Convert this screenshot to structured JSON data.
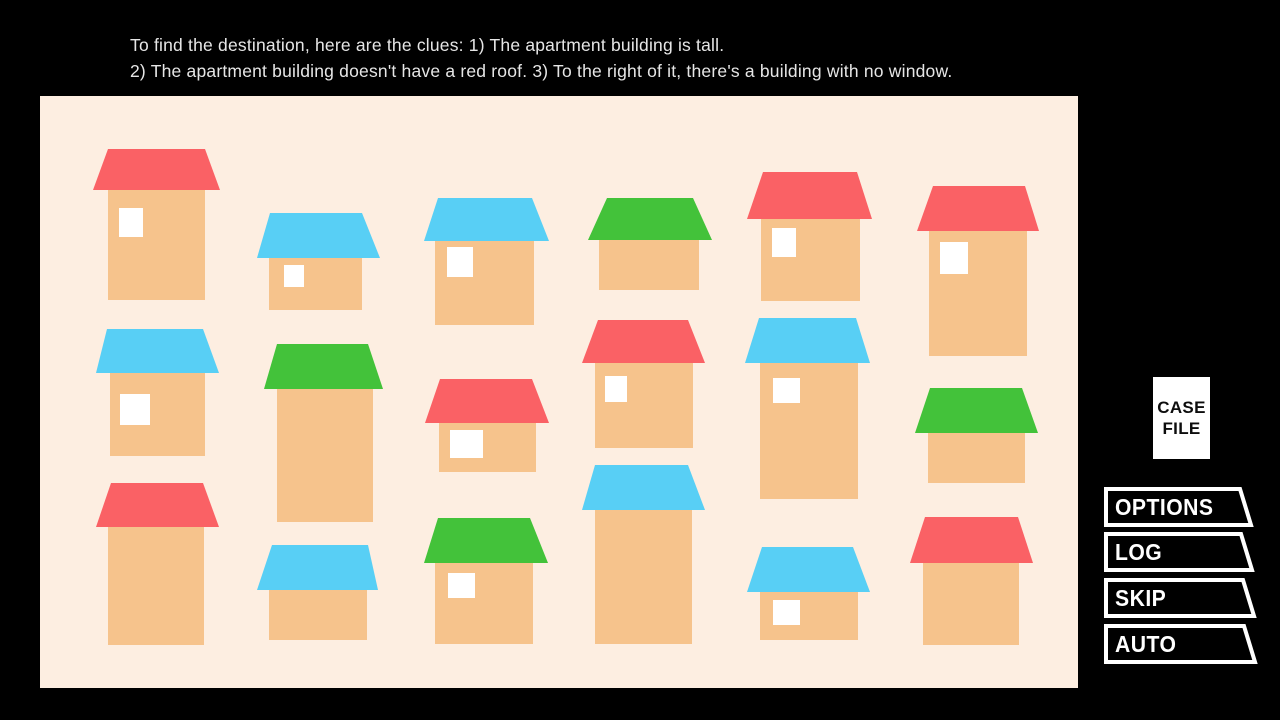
{
  "clue": {
    "line1": "To find the destination, here are the clues: 1) The apartment building is tall.",
    "line2": "2) The apartment building doesn't have a red roof. 3) To the right of it, there's a building with no window."
  },
  "palette": {
    "background": "#000000",
    "panel": "#fdeee1",
    "building_body": "#f6c38c",
    "roof_red": "#fa6165",
    "roof_blue": "#58cff5",
    "roof_green": "#43c23a",
    "window": "#ffffff",
    "clue_text": "#e6e6e6",
    "menu_outline": "#ffffff",
    "menu_fill": "#000000",
    "menu_text": "#ffffff",
    "case_file_bg": "#ffffff",
    "case_file_text": "#0d0d0d"
  },
  "scene": {
    "panel": {
      "x": 40,
      "y": 96,
      "width": 1038,
      "height": 592
    },
    "buildings": [
      {
        "id": "r1c1",
        "roof_color": "roof_red",
        "tall": false,
        "roof": {
          "x": 93,
          "y": 149,
          "w": 127,
          "h": 41,
          "til": 15,
          "tir": 15
        },
        "body": {
          "x": 108,
          "y": 190,
          "w": 97,
          "h": 110
        },
        "window": {
          "x": 119,
          "y": 208,
          "w": 24,
          "h": 29
        }
      },
      {
        "id": "r1c2",
        "roof_color": "roof_blue",
        "tall": false,
        "roof": {
          "x": 257,
          "y": 213,
          "w": 123,
          "h": 45,
          "til": 13,
          "tir": 18
        },
        "body": {
          "x": 269,
          "y": 258,
          "w": 93,
          "h": 52
        },
        "window": {
          "x": 284,
          "y": 265,
          "w": 20,
          "h": 22
        }
      },
      {
        "id": "r1c3",
        "roof_color": "roof_blue",
        "tall": false,
        "roof": {
          "x": 424,
          "y": 198,
          "w": 125,
          "h": 43,
          "til": 14,
          "tir": 17
        },
        "body": {
          "x": 435,
          "y": 241,
          "w": 99,
          "h": 84
        },
        "window": {
          "x": 447,
          "y": 247,
          "w": 26,
          "h": 30
        }
      },
      {
        "id": "r1c4",
        "roof_color": "roof_green",
        "tall": false,
        "roof": {
          "x": 588,
          "y": 198,
          "w": 124,
          "h": 42,
          "til": 19,
          "tir": 19
        },
        "body": {
          "x": 599,
          "y": 240,
          "w": 100,
          "h": 50
        },
        "window": null
      },
      {
        "id": "r1c5",
        "roof_color": "roof_red",
        "tall": false,
        "roof": {
          "x": 747,
          "y": 172,
          "w": 125,
          "h": 47,
          "til": 16,
          "tir": 15
        },
        "body": {
          "x": 761,
          "y": 219,
          "w": 99,
          "h": 82
        },
        "window": {
          "x": 772,
          "y": 228,
          "w": 24,
          "h": 29
        }
      },
      {
        "id": "r1c6",
        "roof_color": "roof_red",
        "tall": true,
        "roof": {
          "x": 917,
          "y": 186,
          "w": 122,
          "h": 45,
          "til": 16,
          "tir": 14
        },
        "body": {
          "x": 929,
          "y": 231,
          "w": 98,
          "h": 125
        },
        "window": {
          "x": 940,
          "y": 242,
          "w": 28,
          "h": 32
        }
      },
      {
        "id": "r2c1",
        "roof_color": "roof_blue",
        "tall": false,
        "roof": {
          "x": 96,
          "y": 329,
          "w": 123,
          "h": 44,
          "til": 11,
          "tir": 16
        },
        "body": {
          "x": 110,
          "y": 373,
          "w": 95,
          "h": 83
        },
        "window": {
          "x": 120,
          "y": 394,
          "w": 30,
          "h": 31
        }
      },
      {
        "id": "r2c2",
        "roof_color": "roof_green",
        "tall": true,
        "roof": {
          "x": 264,
          "y": 344,
          "w": 119,
          "h": 45,
          "til": 13,
          "tir": 15
        },
        "body": {
          "x": 277,
          "y": 389,
          "w": 96,
          "h": 133
        },
        "window": null
      },
      {
        "id": "r2c3",
        "roof_color": "roof_red",
        "tall": false,
        "roof": {
          "x": 425,
          "y": 379,
          "w": 124,
          "h": 44,
          "til": 15,
          "tir": 17
        },
        "body": {
          "x": 439,
          "y": 423,
          "w": 97,
          "h": 49
        },
        "window": {
          "x": 450,
          "y": 430,
          "w": 33,
          "h": 28
        }
      },
      {
        "id": "r2c4",
        "roof_color": "roof_red",
        "tall": false,
        "roof": {
          "x": 582,
          "y": 320,
          "w": 123,
          "h": 43,
          "til": 16,
          "tir": 17
        },
        "body": {
          "x": 595,
          "y": 363,
          "w": 98,
          "h": 85
        },
        "window": {
          "x": 605,
          "y": 376,
          "w": 22,
          "h": 26
        }
      },
      {
        "id": "r2c5",
        "roof_color": "roof_blue",
        "tall": true,
        "roof": {
          "x": 745,
          "y": 318,
          "w": 125,
          "h": 45,
          "til": 14,
          "tir": 14
        },
        "body": {
          "x": 760,
          "y": 363,
          "w": 98,
          "h": 136
        },
        "window": {
          "x": 773,
          "y": 378,
          "w": 27,
          "h": 25
        }
      },
      {
        "id": "r2c6",
        "roof_color": "roof_green",
        "tall": false,
        "roof": {
          "x": 915,
          "y": 388,
          "w": 123,
          "h": 45,
          "til": 15,
          "tir": 16
        },
        "body": {
          "x": 928,
          "y": 433,
          "w": 97,
          "h": 50
        },
        "window": null
      },
      {
        "id": "r3c1",
        "roof_color": "roof_red",
        "tall": true,
        "roof": {
          "x": 96,
          "y": 483,
          "w": 123,
          "h": 44,
          "til": 15,
          "tir": 16
        },
        "body": {
          "x": 108,
          "y": 527,
          "w": 96,
          "h": 118
        },
        "window": null
      },
      {
        "id": "r3c2",
        "roof_color": "roof_blue",
        "tall": false,
        "roof": {
          "x": 257,
          "y": 545,
          "w": 121,
          "h": 45,
          "til": 15,
          "tir": 10
        },
        "body": {
          "x": 269,
          "y": 590,
          "w": 98,
          "h": 50
        },
        "window": null
      },
      {
        "id": "r3c3",
        "roof_color": "roof_green",
        "tall": false,
        "roof": {
          "x": 424,
          "y": 518,
          "w": 124,
          "h": 45,
          "til": 14,
          "tir": 18
        },
        "body": {
          "x": 435,
          "y": 563,
          "w": 98,
          "h": 81
        },
        "window": {
          "x": 448,
          "y": 573,
          "w": 27,
          "h": 25
        }
      },
      {
        "id": "r3c4",
        "roof_color": "roof_blue",
        "tall": true,
        "roof": {
          "x": 582,
          "y": 465,
          "w": 123,
          "h": 45,
          "til": 13,
          "tir": 17
        },
        "body": {
          "x": 595,
          "y": 510,
          "w": 97,
          "h": 134
        },
        "window": null
      },
      {
        "id": "r3c5",
        "roof_color": "roof_blue",
        "tall": false,
        "roof": {
          "x": 747,
          "y": 547,
          "w": 123,
          "h": 45,
          "til": 15,
          "tir": 17
        },
        "body": {
          "x": 760,
          "y": 592,
          "w": 98,
          "h": 48
        },
        "window": {
          "x": 773,
          "y": 600,
          "w": 27,
          "h": 25
        }
      },
      {
        "id": "r3c6",
        "roof_color": "roof_red",
        "tall": false,
        "roof": {
          "x": 910,
          "y": 517,
          "w": 123,
          "h": 46,
          "til": 15,
          "tir": 15
        },
        "body": {
          "x": 923,
          "y": 563,
          "w": 96,
          "h": 82
        },
        "window": null
      }
    ]
  },
  "case_file": {
    "line1": "CASE",
    "line2": "FILE"
  },
  "menu": {
    "buttons": [
      {
        "label": "OPTIONS"
      },
      {
        "label": "LOG"
      },
      {
        "label": "SKIP"
      },
      {
        "label": "AUTO"
      }
    ]
  }
}
